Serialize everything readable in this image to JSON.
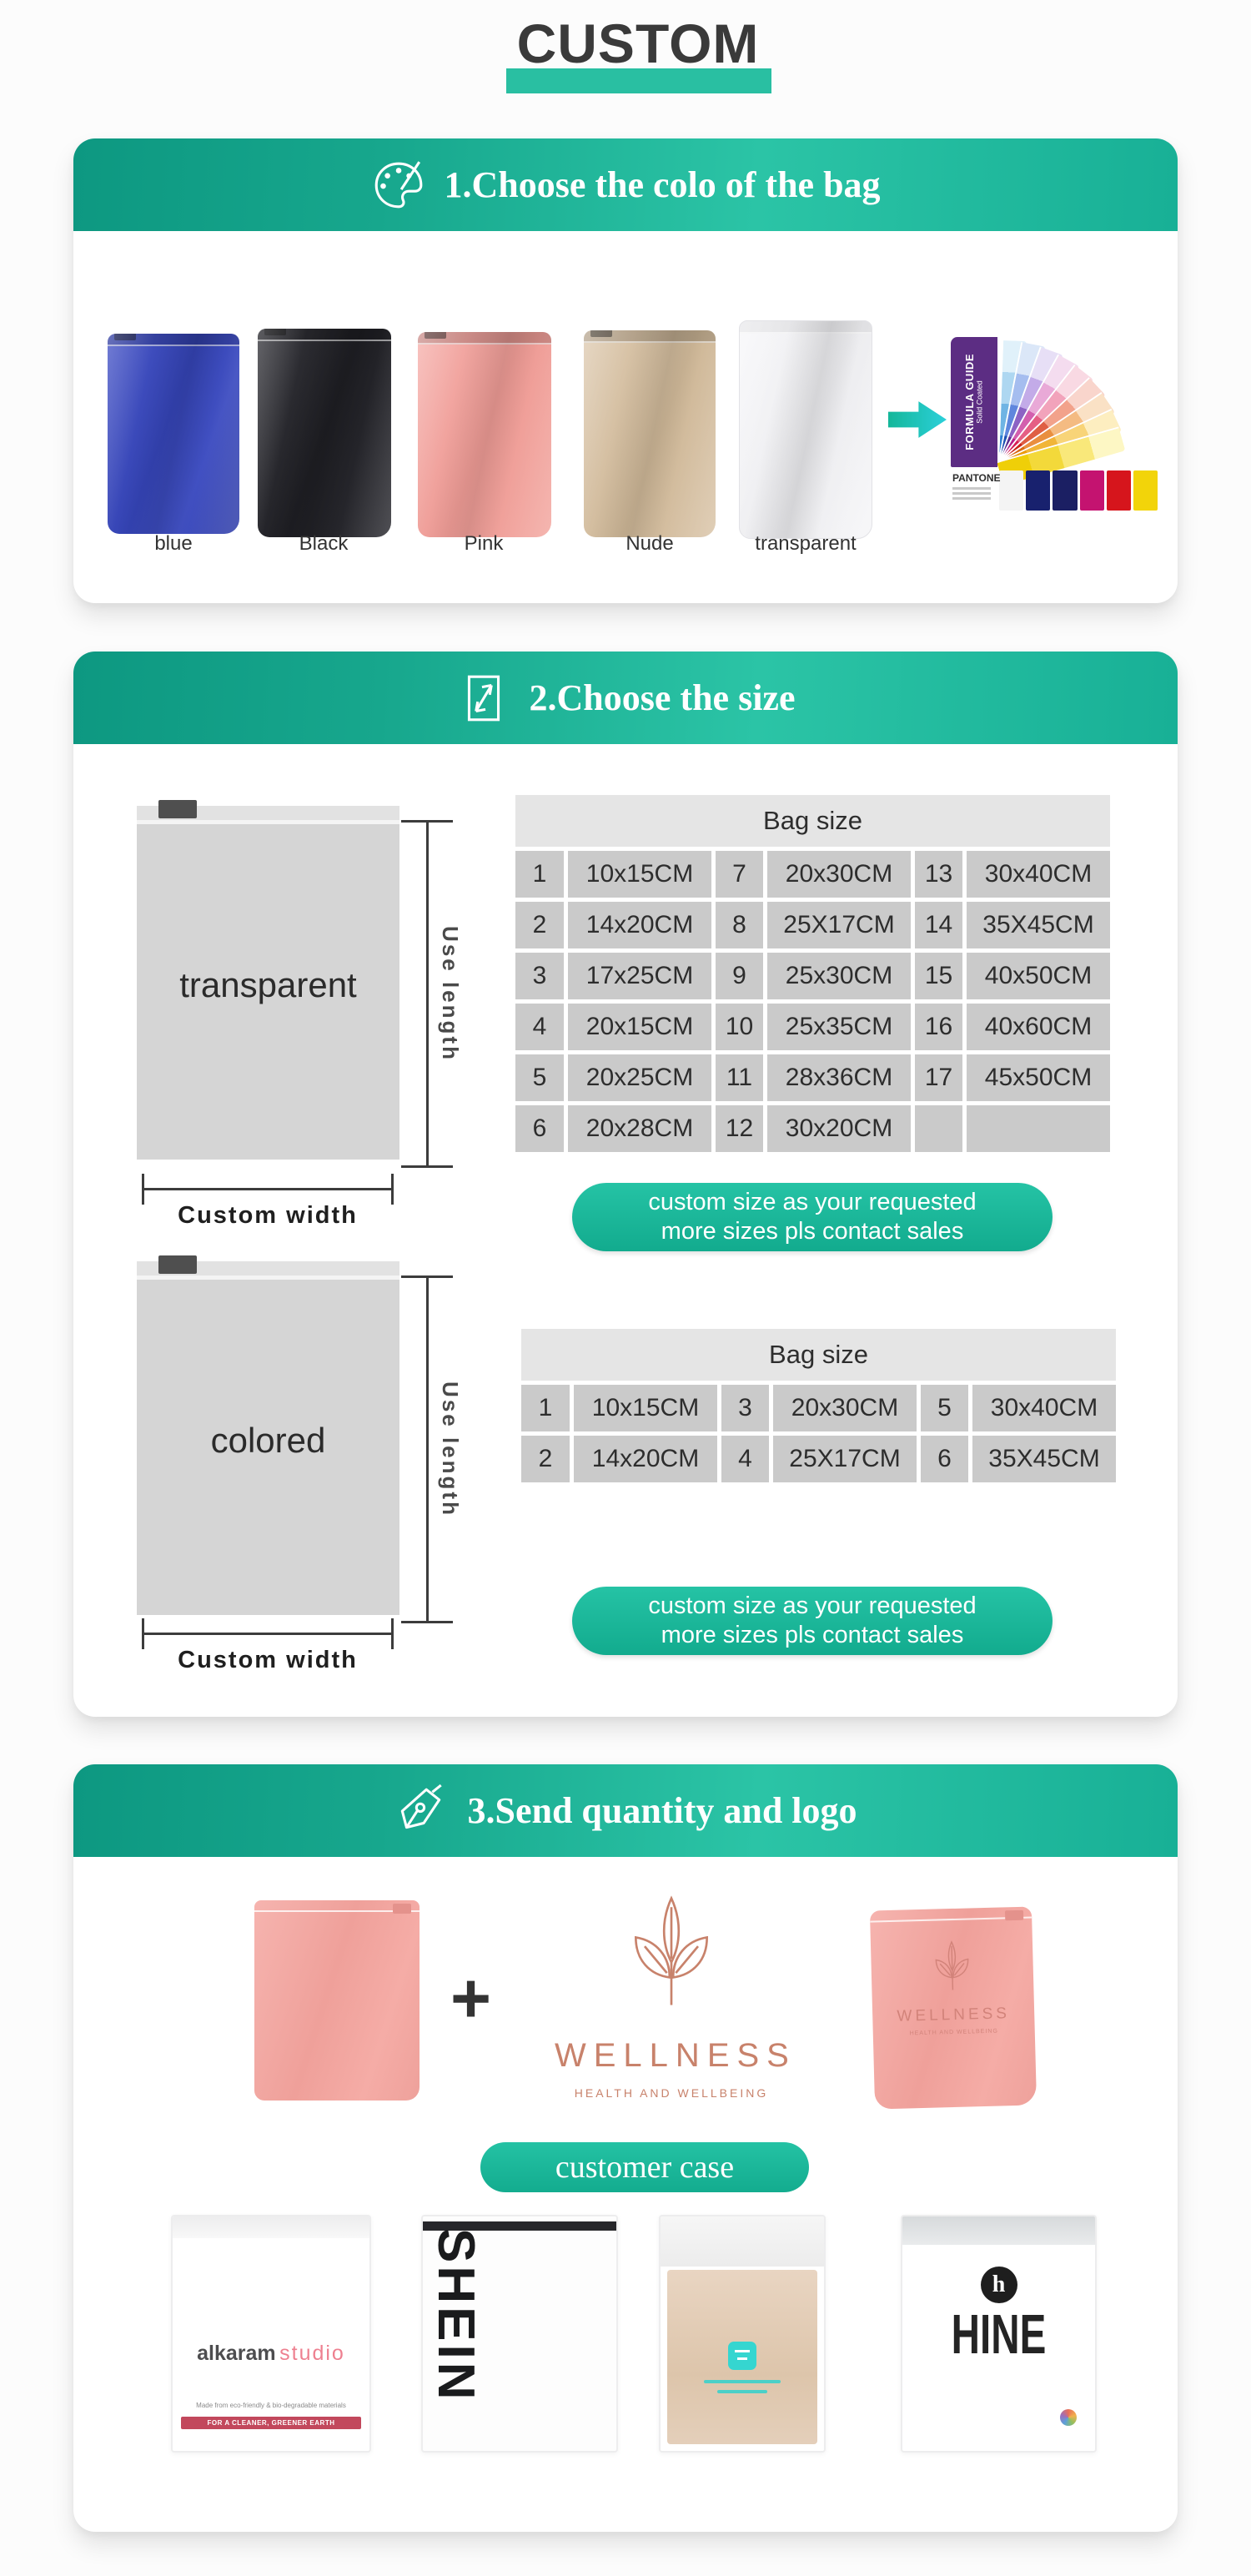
{
  "title": "CUSTOM",
  "theme": {
    "teal": "#12a88d",
    "teal_light": "#2bc4a6",
    "underline": "#29bfa2",
    "pill": "#17b798"
  },
  "section1": {
    "heading": "1.Choose the colo of the bag",
    "bags": [
      {
        "label": "blue",
        "color": "#3f4dc0"
      },
      {
        "label": "Black",
        "color": "#26262b"
      },
      {
        "label": "Pink",
        "color": "#f2a5a0"
      },
      {
        "label": "Nude",
        "color": "#d6c1a4"
      },
      {
        "label": "transparent",
        "color": "#f4f4f6"
      }
    ],
    "pantone": {
      "spine_line1": "FORMULA GUIDE",
      "spine_line2": "Solid Coated",
      "brand": "PANTONE"
    }
  },
  "section2": {
    "heading": "2.Choose the size",
    "diagram_transparent_label": "transparent",
    "diagram_colored_label": "colored",
    "use_length": "Use length",
    "custom_width": "Custom width",
    "table_title": "Bag size",
    "table1_rows": [
      [
        "1",
        "10x15CM",
        "7",
        "20x30CM",
        "13",
        "30x40CM"
      ],
      [
        "2",
        "14x20CM",
        "8",
        "25X17CM",
        "14",
        "35X45CM"
      ],
      [
        "3",
        "17x25CM",
        "9",
        "25x30CM",
        "15",
        "40x50CM"
      ],
      [
        "4",
        "20x15CM",
        "10",
        "25x35CM",
        "16",
        "40x60CM"
      ],
      [
        "5",
        "20x25CM",
        "11",
        "28x36CM",
        "17",
        "45x50CM"
      ],
      [
        "6",
        "20x28CM",
        "12",
        "30x20CM",
        "",
        ""
      ]
    ],
    "table2_rows": [
      [
        "1",
        "10x15CM",
        "3",
        "20x30CM",
        "5",
        "30x40CM"
      ],
      [
        "2",
        "14x20CM",
        "4",
        "25X17CM",
        "6",
        "35X45CM"
      ]
    ],
    "pill_line1": "custom size as your requested",
    "pill_line2": "more sizes pls contact sales"
  },
  "section3": {
    "heading": "3.Send quantity and logo",
    "plus": "+",
    "equals": "=",
    "logo_name": "WELLNESS",
    "logo_tagline": "HEALTH AND WELLBEING",
    "customer_case": "customer case",
    "case1_brand_bold": "alkaram",
    "case1_brand_light": "studio",
    "case1_eco_line": "Made from eco-friendly & bio-degradable materials",
    "case1_stripe": "FOR A CLEANER, GREENER EARTH",
    "case2_brand": "SHEIN",
    "case4_monogram": "h",
    "case4_brand": "HINE"
  }
}
